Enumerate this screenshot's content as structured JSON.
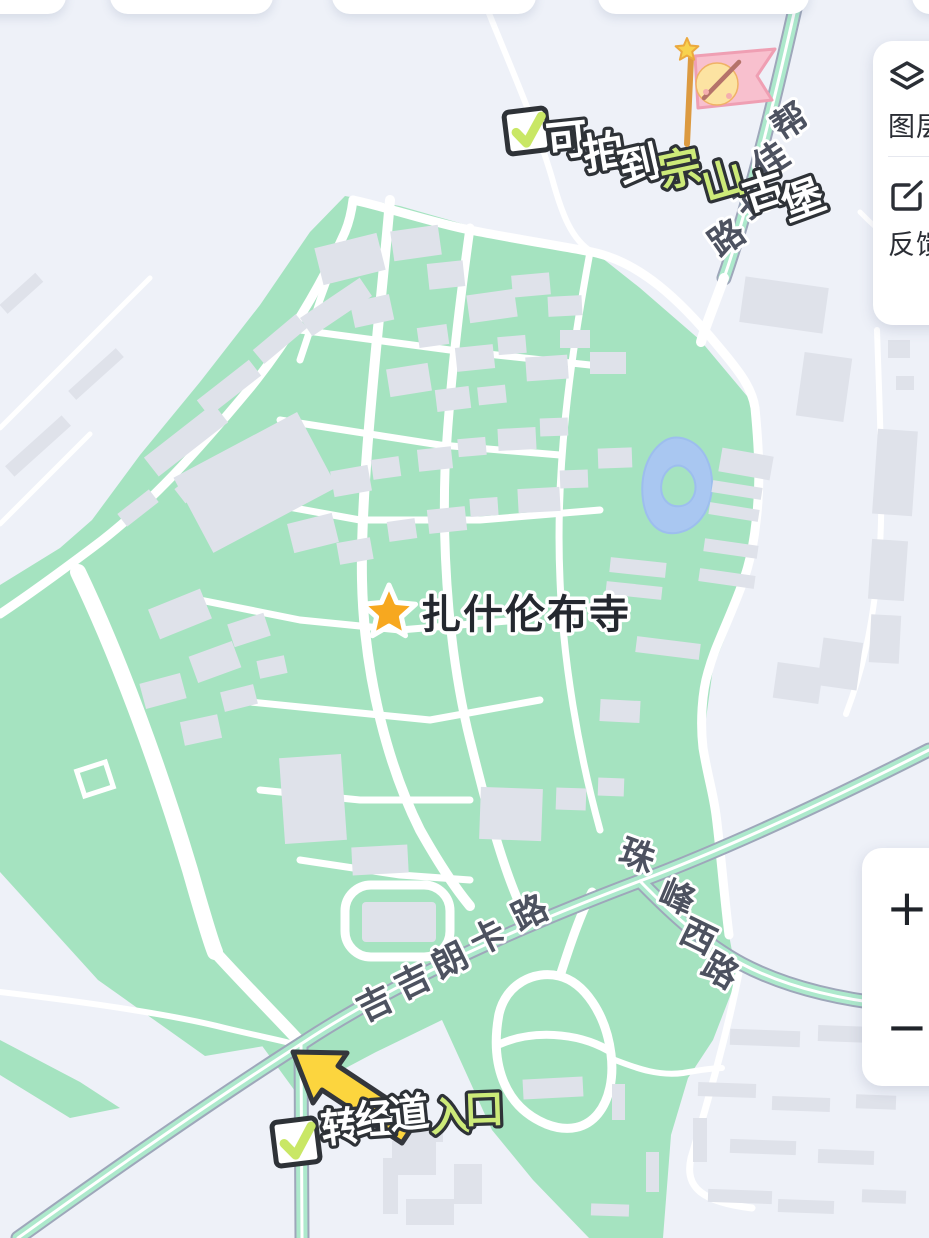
{
  "map": {
    "poi_label": "扎什伦布寺",
    "road_labels": {
      "bangjiakonglu": [
        "帮",
        "佳",
        "孔",
        "路"
      ],
      "jijilangkalu": [
        "吉",
        "吉",
        "朗",
        "卡",
        "路"
      ],
      "zhufengxilu": [
        "珠",
        "峰",
        "西",
        "路"
      ]
    },
    "annotations": {
      "zongshan_note": [
        "可",
        "拍",
        "到",
        "宗",
        "山",
        "古",
        "堡"
      ],
      "zhuanjing_note": [
        "转",
        "经",
        "道",
        "入",
        "口"
      ]
    }
  },
  "controls": {
    "layers_label": "图层",
    "feedback_label": "反馈",
    "zoom_in_label": "+",
    "zoom_out_label": "−"
  },
  "colors": {
    "background": "#eef1f8",
    "park_green": "#a5e3c0",
    "building_gray": "#dfe2ea",
    "road_white": "#ffffff",
    "main_road_mint": "#ade9cc",
    "road_casing": "#9ea7ba",
    "lake_blue": "#a9c7f1",
    "annotation_yellow_green": "#cdea79",
    "annotation_outline": "#2e3237",
    "arrow_yellow": "#fcd53e",
    "flag_pink": "#f8c0ce",
    "star_orange": "#f7a81f",
    "road_label_color": "#4d5260",
    "poi_text_color": "#24282f"
  }
}
